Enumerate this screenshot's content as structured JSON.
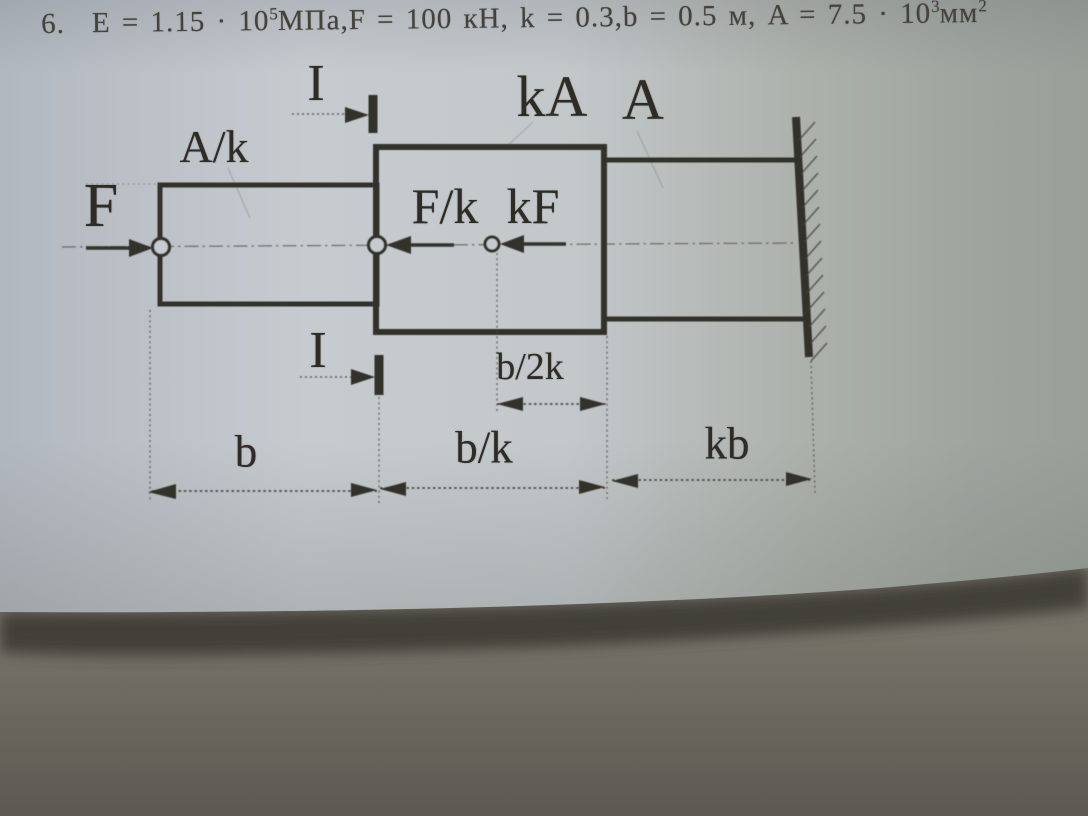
{
  "problem": {
    "number": "6.",
    "seg1": "E = 1.15 · 10",
    "sup1": "5",
    "seg2": "МПа,F = 100 кН, k = 0.3,b = 0.5 м, A = 7.5 · 10",
    "sup2": "3",
    "seg3": "мм",
    "sup3": "2"
  },
  "diagram": {
    "labels": {
      "force_f": "F",
      "area_left": "A/k",
      "area_mid": "kA",
      "area_right": "A",
      "force_fk": "F/k",
      "force_kf": "kF",
      "section_top": "I",
      "section_bottom": "I",
      "dim_b": "b",
      "dim_bk": "b/k",
      "dim_b2k": "b/2k",
      "dim_kb": "kb"
    }
  },
  "colors": {
    "ink": "#33302a",
    "paper_light": "#c6cbcf",
    "paper_dark": "#9aa099",
    "table_surface": "#6b6860",
    "edge_shadow": "#3e3b35"
  }
}
